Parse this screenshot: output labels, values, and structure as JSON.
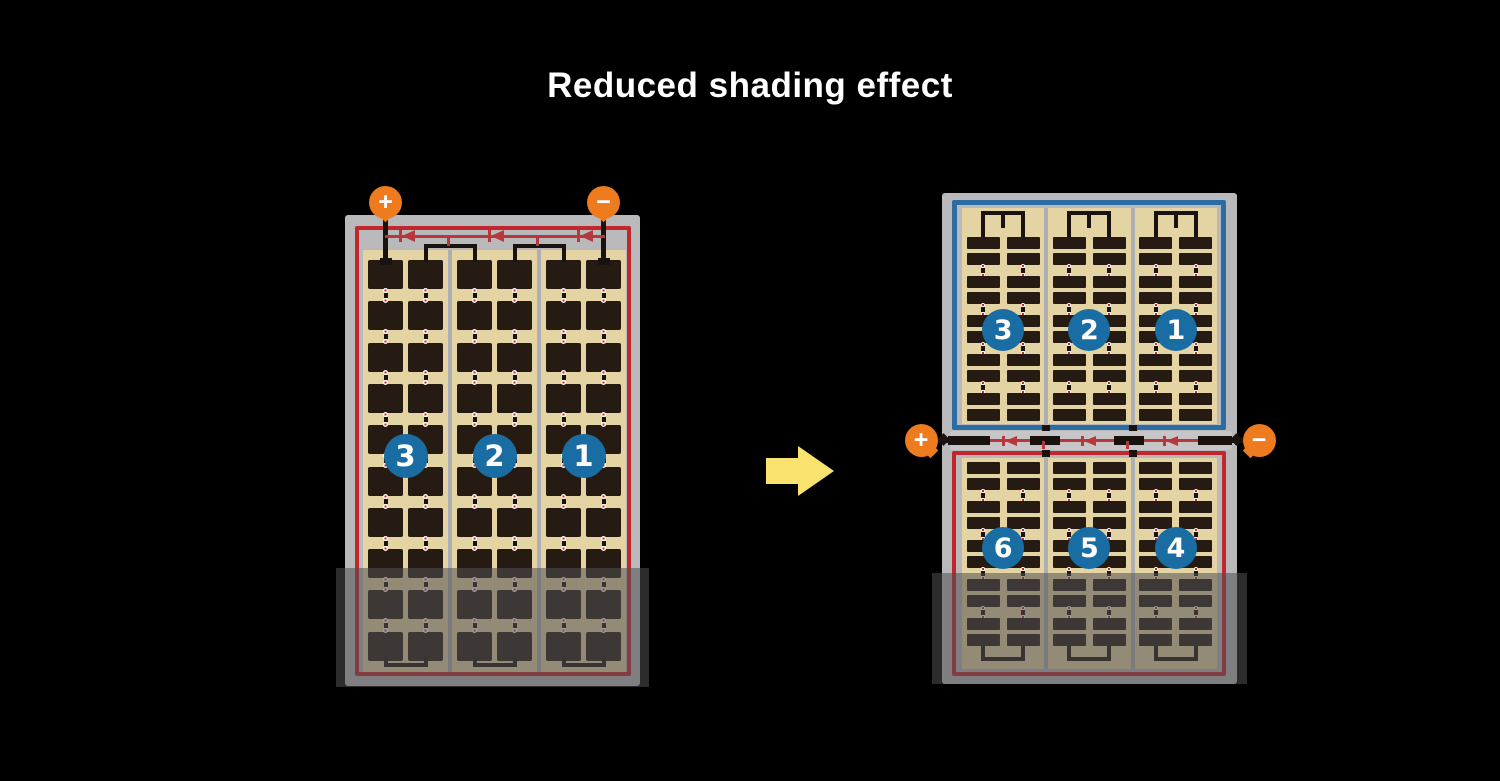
{
  "title": "Reduced shading effect",
  "colors": {
    "background": "#000000",
    "panel_frame_gray": "#b9b9bc",
    "divider_gray": "#aeaeb5",
    "cell_field_tan": "#e4d3a3",
    "cell_dark_brown": "#261b12",
    "string_circle_blue": "#1a6da3",
    "module_border_red": "#c1272d",
    "module_border_blue": "#2b6ca3",
    "diode_line_red": "#b8373d",
    "terminal_orange": "#ee7c1f",
    "wire_black": "#1a120e",
    "junction_strip_gray": "#c6c6c8",
    "arrow_yellow": "#f9e36e",
    "shade_overlay": "rgba(80,80,82,0.55)"
  },
  "left_module": {
    "description": "conventional full-cell module, single series circuit, bottom rows shaded",
    "terminal_positive": "+",
    "terminal_negative": "−",
    "bypass_diodes": 3,
    "strings": [
      "3",
      "2",
      "1"
    ],
    "shaded_bottom": true
  },
  "right_module": {
    "description": "half-cut split module, top and bottom half circuits with center junction, bottom rows shaded",
    "terminal_positive": "+",
    "terminal_negative": "−",
    "bypass_diodes": 3,
    "top_strings": [
      "3",
      "2",
      "1"
    ],
    "bottom_strings": [
      "6",
      "5",
      "4"
    ],
    "shaded_bottom": true
  }
}
